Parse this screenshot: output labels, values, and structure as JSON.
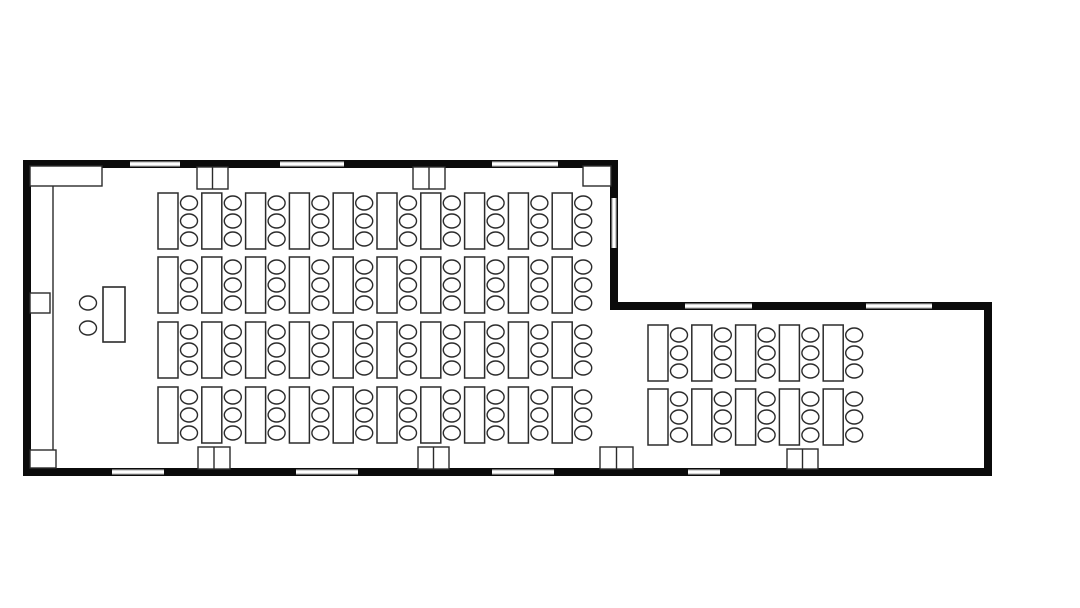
{
  "meta": {
    "title": "Classroom floor plan with student desks and chairs",
    "type": "floor-plan"
  },
  "canvas": {
    "width": 1080,
    "height": 608,
    "background": "#ffffff",
    "wall_color": "#0b0b0b",
    "line_color": "#2b2b2b",
    "window_edge_color": "#555555"
  },
  "walls": [
    {
      "name": "wall-top-main",
      "x": 23,
      "y": 160,
      "w": 595,
      "h": 8
    },
    {
      "name": "wall-left",
      "x": 23,
      "y": 160,
      "w": 8,
      "h": 316
    },
    {
      "name": "wall-right-main",
      "x": 610,
      "y": 160,
      "w": 8,
      "h": 150
    },
    {
      "name": "wall-top-extension",
      "x": 610,
      "y": 302,
      "w": 382,
      "h": 8
    },
    {
      "name": "wall-right-extension",
      "x": 984,
      "y": 302,
      "w": 8,
      "h": 174
    },
    {
      "name": "wall-bottom",
      "x": 23,
      "y": 468,
      "w": 969,
      "h": 8
    }
  ],
  "windows": [
    {
      "orient": "h",
      "x": 130,
      "y": 161,
      "w": 50,
      "h": 6
    },
    {
      "orient": "h",
      "x": 280,
      "y": 161,
      "w": 64,
      "h": 6
    },
    {
      "orient": "h",
      "x": 492,
      "y": 161,
      "w": 66,
      "h": 6
    },
    {
      "orient": "v",
      "x": 611,
      "y": 198,
      "w": 6,
      "h": 50
    },
    {
      "orient": "h",
      "x": 685,
      "y": 303,
      "w": 67,
      "h": 6
    },
    {
      "orient": "h",
      "x": 866,
      "y": 303,
      "w": 66,
      "h": 6
    },
    {
      "orient": "h",
      "x": 112,
      "y": 469,
      "w": 52,
      "h": 6
    },
    {
      "orient": "h",
      "x": 296,
      "y": 469,
      "w": 62,
      "h": 6
    },
    {
      "orient": "h",
      "x": 492,
      "y": 469,
      "w": 62,
      "h": 6
    },
    {
      "orient": "h",
      "x": 688,
      "y": 469,
      "w": 32,
      "h": 6
    }
  ],
  "door_piers": [
    {
      "x": 197,
      "y": 167,
      "w": 31,
      "h": 22
    },
    {
      "x": 413,
      "y": 167,
      "w": 32,
      "h": 22
    },
    {
      "x": 198,
      "y": 447,
      "w": 32,
      "h": 22
    },
    {
      "x": 418,
      "y": 447,
      "w": 31,
      "h": 22
    },
    {
      "x": 600,
      "y": 447,
      "w": 33,
      "h": 22
    },
    {
      "x": 787,
      "y": 449,
      "w": 31,
      "h": 20
    }
  ],
  "fixtures": [
    {
      "name": "closet",
      "x": 30,
      "y": 166,
      "w": 72,
      "h": 20
    },
    {
      "name": "corner-cabinet",
      "x": 583,
      "y": 166,
      "w": 28,
      "h": 20
    },
    {
      "name": "radiator",
      "x": 30,
      "y": 293,
      "w": 20,
      "h": 20
    },
    {
      "name": "corner-box",
      "x": 30,
      "y": 450,
      "w": 26,
      "h": 18
    }
  ],
  "partition": {
    "x": 53,
    "y1": 186,
    "y2": 450
  },
  "teacher": {
    "desk": {
      "x": 103,
      "y": 287,
      "w": 22,
      "h": 55
    },
    "chairs": [
      {
        "cx": 88,
        "cy": 303
      },
      {
        "cx": 88,
        "cy": 328
      }
    ]
  },
  "desk_blocks": [
    {
      "name": "main-block",
      "x_start": 158,
      "x_step": 43.8,
      "cols": 10,
      "row_y": [
        193,
        257,
        322,
        387
      ]
    },
    {
      "name": "extension-block",
      "x_start": 648,
      "x_step": 43.8,
      "cols": 5,
      "row_y": [
        325,
        389
      ]
    }
  ],
  "desk": {
    "w": 20,
    "h": 56
  },
  "chair": {
    "rx": 8.5,
    "ry": 7,
    "dx": 31,
    "dy": [
      10,
      28,
      46
    ]
  }
}
